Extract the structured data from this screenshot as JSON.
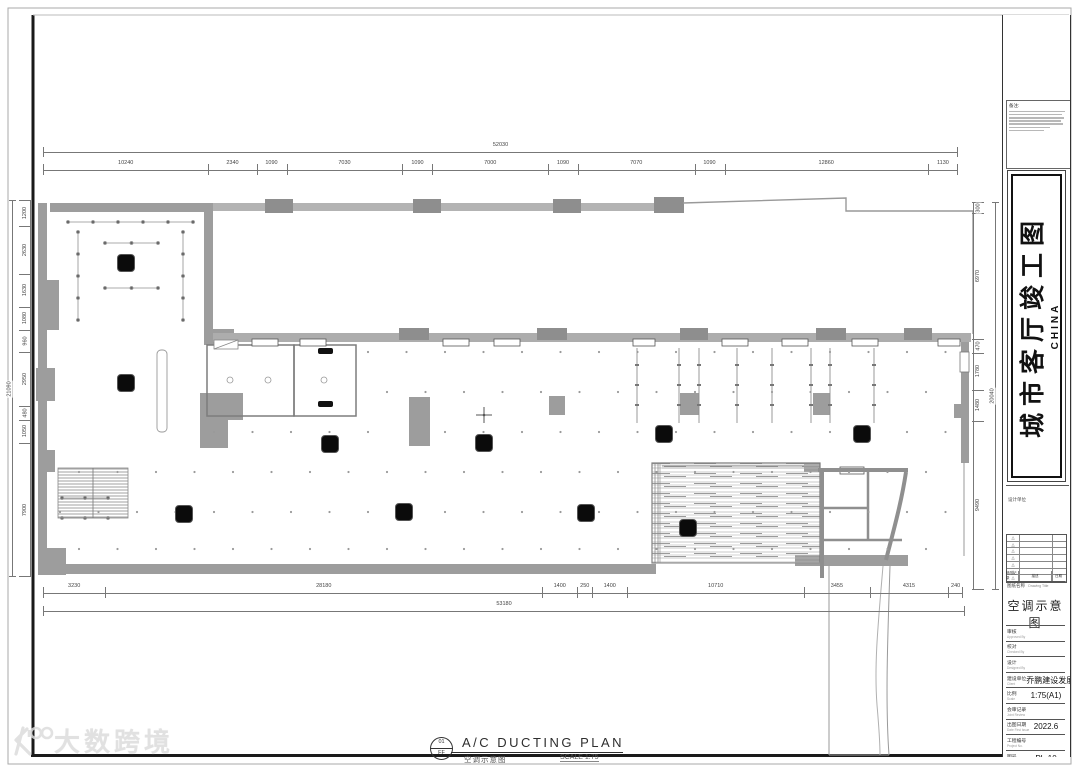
{
  "sheet": {
    "watermark_text": "大数跨境",
    "footer": {
      "ref_top": "01",
      "ref_bottom": "FF",
      "title_en": "A/C DUCTING PLAN",
      "title_cn": "空调示意图",
      "scale_label": "SCALE 1:75"
    }
  },
  "title_block": {
    "notes_title": "备注:",
    "project_name": "城市客厅竣工图",
    "project_name_sub": "CHINA",
    "stamp_label": "设计单位",
    "revision_table": {
      "mark": "△",
      "rows": [
        {},
        {},
        {},
        {},
        {},
        {},
        {}
      ],
      "col1": "修改记录",
      "col1_en": "Rev.",
      "col2": "描述",
      "col2_en": "Description",
      "col3": "日期",
      "col3_en": "Date"
    },
    "drawing_title_label": "图纸名称",
    "drawing_title_label_en": "Drawing Title",
    "drawing_title": "空调示意图",
    "fields": [
      {
        "label": "审核",
        "label_en": "Approved By",
        "value": ""
      },
      {
        "label": "校对",
        "label_en": "Checked By",
        "value": ""
      },
      {
        "label": "设计",
        "label_en": "Designed By",
        "value": ""
      },
      {
        "label": "建设单位",
        "label_en": "Client",
        "value": "乔鹏建设发展有限公司"
      },
      {
        "label": "比例",
        "label_en": "Scale",
        "value": "1:75(A1)"
      },
      {
        "label": "会审记录",
        "label_en": "Joint Review",
        "value": ""
      },
      {
        "label": "出图日期",
        "label_en": "Date First Issue",
        "value": "2022.6"
      },
      {
        "label": "工程编号",
        "label_en": "Project No.",
        "value": ""
      },
      {
        "label": "图号",
        "label_en": "Drawing No.",
        "value": "PL-10"
      },
      {
        "label": "备注",
        "label_en": "Remarks",
        "value": ""
      }
    ]
  },
  "dimensions": {
    "top_overall": "52030",
    "top_segments": [
      10240,
      2340,
      1090,
      7030,
      1090,
      7000,
      1090,
      7070,
      1090,
      12860,
      1130
    ],
    "bottom_overall": "53180",
    "bottom_segments": [
      3230,
      28180,
      1400,
      250,
      1400,
      10710,
      3455,
      4315,
      240
    ],
    "left_overall": "21090",
    "left_segments": [
      1200,
      2630,
      1630,
      1080,
      960,
      2950,
      480,
      1050,
      7900
    ],
    "right_overall": "20040",
    "right_segments": [
      300,
      6970,
      470,
      1780,
      1480,
      9490
    ]
  },
  "plan": {
    "ac_unit_symbol": "ceiling-cassette-ac-unit",
    "ac_unit_count": 10
  }
}
